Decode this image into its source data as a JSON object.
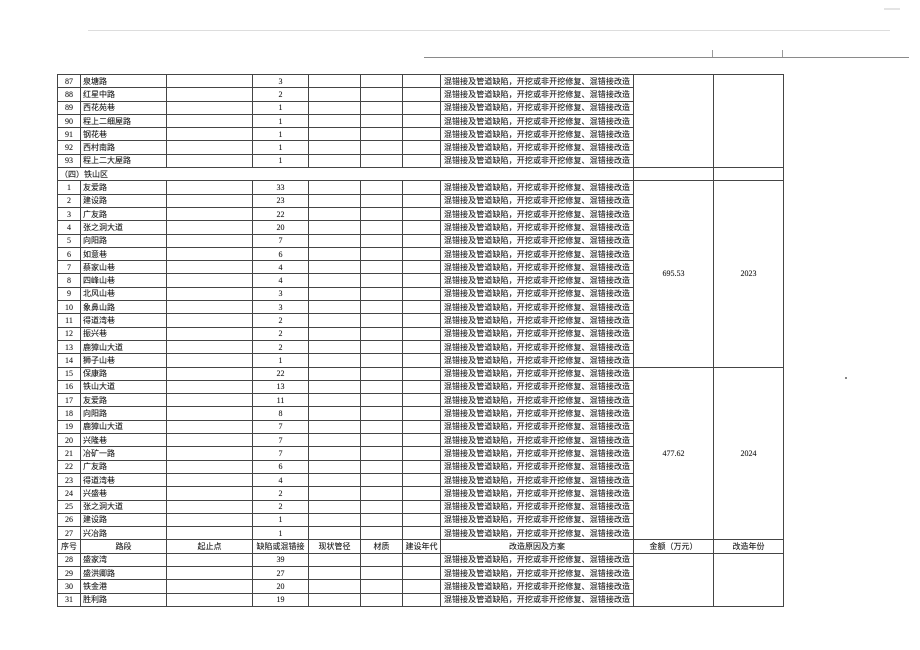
{
  "table": {
    "headers": [
      "序号",
      "路段",
      "起止点",
      "缺陷或混错接",
      "现状管径",
      "材质",
      "建设年代",
      "改造原因及方案",
      "金额（万元）",
      "改造年份"
    ],
    "section_label": "（四）铁山区",
    "reason_text": "混错接及管道缺陷，开挖或非开挖修复、混错接改造",
    "block_order": [
      "rows-0",
      "section",
      "rows-1",
      "rows-2",
      "header",
      "rows-3"
    ],
    "groups": [
      {
        "amount": "",
        "retrofit_year": "",
        "rows": [
          [
            "87",
            "泉塘路",
            "3"
          ],
          [
            "88",
            "红星中路",
            "2"
          ],
          [
            "89",
            "西花苑巷",
            "1"
          ],
          [
            "90",
            "程上二细屋路",
            "1"
          ],
          [
            "91",
            "钢花巷",
            "1"
          ],
          [
            "92",
            "西村南路",
            "1"
          ],
          [
            "93",
            "程上二大屋路",
            "1"
          ]
        ]
      },
      {
        "amount": "695.53",
        "retrofit_year": "2023",
        "rows": [
          [
            "1",
            "友爱路",
            "33"
          ],
          [
            "2",
            "建设路",
            "23"
          ],
          [
            "3",
            "广友路",
            "22"
          ],
          [
            "4",
            "张之洞大道",
            "20"
          ],
          [
            "5",
            "向阳路",
            "7"
          ],
          [
            "6",
            "如意巷",
            "6"
          ],
          [
            "7",
            "蔡家山巷",
            "4"
          ],
          [
            "8",
            "四峰山巷",
            "4"
          ],
          [
            "9",
            "北风山巷",
            "3"
          ],
          [
            "10",
            "象鼻山路",
            "3"
          ],
          [
            "11",
            "得道湾巷",
            "2"
          ],
          [
            "12",
            "振兴巷",
            "2"
          ],
          [
            "13",
            "鹿獐山大道",
            "2"
          ],
          [
            "14",
            "狮子山巷",
            "1"
          ]
        ]
      },
      {
        "amount": "477.62",
        "retrofit_year": "2024",
        "rows": [
          [
            "15",
            "保康路",
            "22"
          ],
          [
            "16",
            "铁山大道",
            "13"
          ],
          [
            "17",
            "友爱路",
            "11"
          ],
          [
            "18",
            "向阳路",
            "8"
          ],
          [
            "19",
            "鹿獐山大道",
            "7"
          ],
          [
            "20",
            "兴隆巷",
            "7"
          ],
          [
            "21",
            "冶矿一路",
            "7"
          ],
          [
            "22",
            "广友路",
            "6"
          ],
          [
            "23",
            "得道湾巷",
            "4"
          ],
          [
            "24",
            "兴盛巷",
            "2"
          ],
          [
            "25",
            "张之洞大道",
            "2"
          ],
          [
            "26",
            "建设路",
            "1"
          ],
          [
            "27",
            "兴冶路",
            "1"
          ]
        ]
      },
      {
        "amount": "",
        "retrofit_year": "",
        "rows": [
          [
            "28",
            "盛家湾",
            "39"
          ],
          [
            "29",
            "盛洪卿路",
            "27"
          ],
          [
            "30",
            "铁金港",
            "20"
          ],
          [
            "31",
            "胜利路",
            "19"
          ]
        ]
      }
    ]
  }
}
